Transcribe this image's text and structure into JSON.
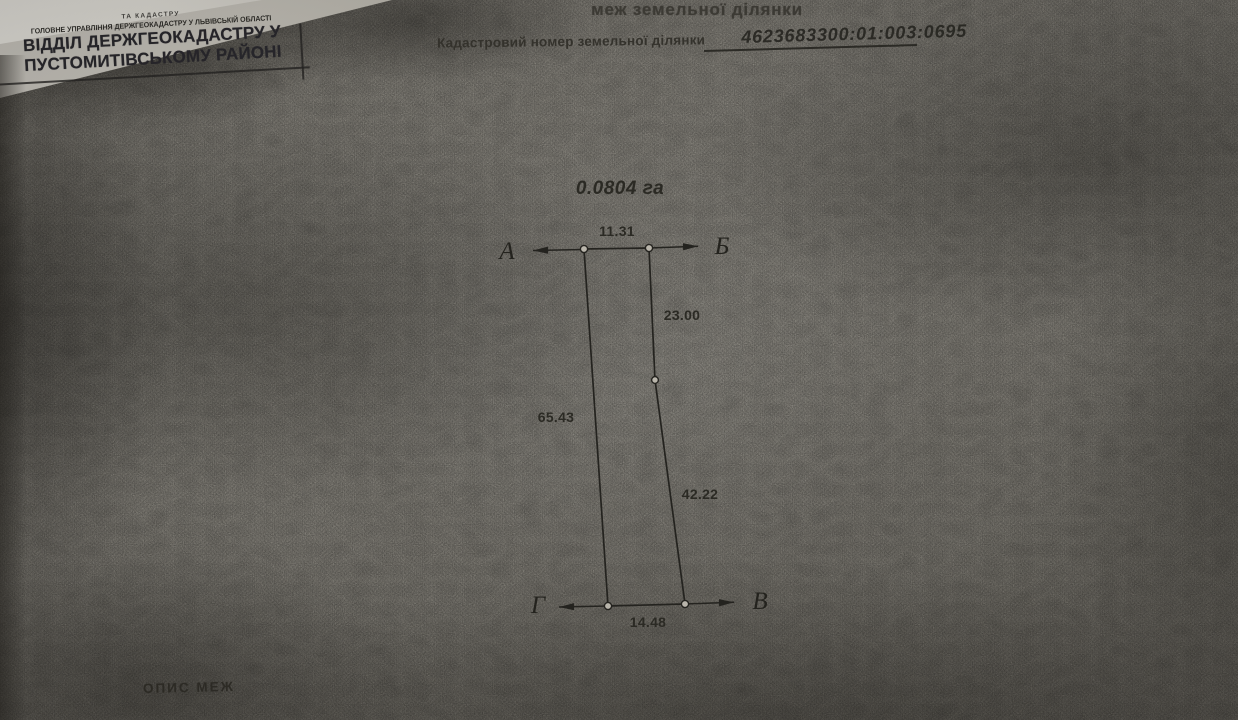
{
  "page": {
    "title_fragment": "меж земельної ділянки",
    "cadastral_label": "Кадастровий номер земельної ділянки",
    "cadastral_number": "4623683300:01:003:0695",
    "footer_heading": "ОПИС МЕЖ"
  },
  "stamp": {
    "small_top": "ТА КАДАСТРУ",
    "small_line": "ГОЛОВНЕ УПРАВЛІННЯ ДЕРЖГЕОКАДАСТРУ У ЛЬВІВСЬКІЙ ОБЛАСТІ",
    "main_line1": "ВІДДІЛ ДЕРЖГЕОКАДАСТРУ У",
    "main_line2": "ПУСТОМИТІВСЬКОМУ РАЙОНІ"
  },
  "plan": {
    "area": "0.0804 га",
    "vertices": {
      "a": "А",
      "b": "Б",
      "v": "В",
      "g": "Г"
    },
    "dimensions": {
      "top": "11.31",
      "right_upper": "23.00",
      "right_lower": "42.22",
      "bottom": "14.48",
      "left": "65.43"
    }
  },
  "colors": {
    "paper": "#b4b0a6",
    "paper_dark": "#86827a",
    "ink": "#24231f",
    "stamp_ink": "#27262b"
  }
}
